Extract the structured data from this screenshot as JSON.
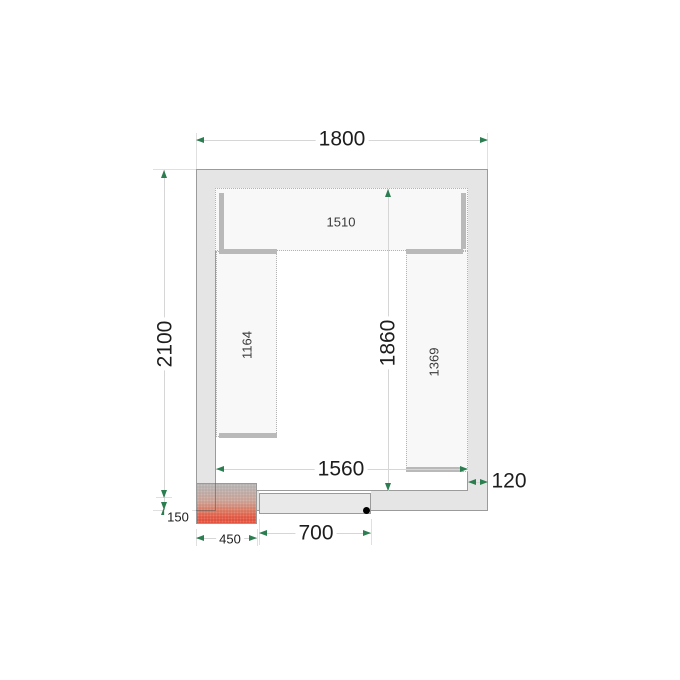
{
  "drawing_type": "cold-room-floor-plan",
  "colors": {
    "wall_fill": "#e5e5e5",
    "wall_border": "#9b9b9b",
    "room_fill": "#ffffff",
    "shelf_fill": "#f8f8f8",
    "shelf_border": "#b3b3b3",
    "shelf_edge": "#b9b9b9",
    "dim_line": "#d6d6d6",
    "ext_line": "#e0e0e0",
    "accent_green": "#2a7e50",
    "text_dark": "#1d1d1d",
    "text_mid": "#3a3a3a",
    "door_fill": "#e9e9e9",
    "unit_red": "#e14b36",
    "unit_gray": "#b2aead",
    "dot_black": "#000000"
  },
  "dims": {
    "outer_width_mm": "1800",
    "outer_height_mm": "2100",
    "inner_width_mm": "1560",
    "inner_height_mm": "1860",
    "wall_thickness_mm": "120",
    "unit_offset_mm": "150",
    "unit_width_mm": "450",
    "door_width_mm": "700"
  },
  "shelves": {
    "top_length_mm": "1510",
    "left_length_mm": "1164",
    "right_length_mm": "1369"
  }
}
